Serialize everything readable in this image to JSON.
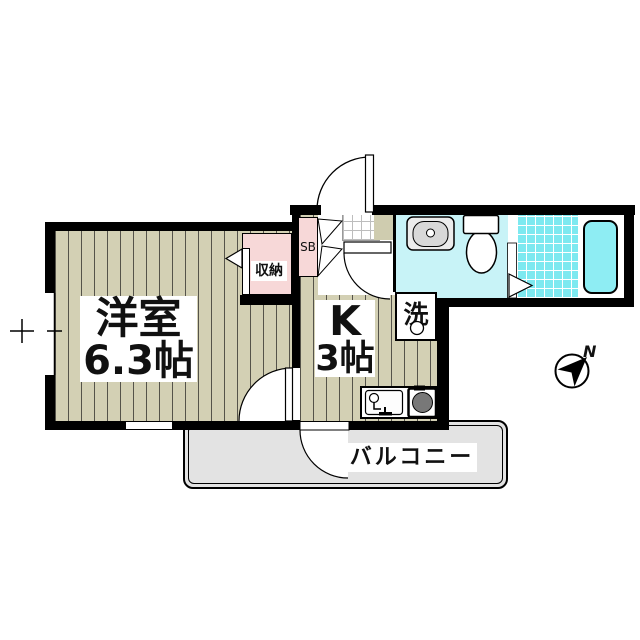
{
  "plan": {
    "western_room": {
      "name": "洋室",
      "area": "6.3帖"
    },
    "kitchen": {
      "name": "K",
      "area": "3帖"
    },
    "closet_label": "収納",
    "shoe_box_label": "SB",
    "laundry_label": "洗",
    "balcony_label": "バルコニー",
    "compass_north": "N"
  },
  "colors": {
    "wall": "#000000",
    "flooring_beige": "#d3d0b4",
    "closet_pink": "#f7d8d8",
    "washroom_cyan": "#c8f3f7",
    "bath_tile_cyan": "#7de9f0",
    "bathtub_cyan": "#8eedf3",
    "balcony_gray": "#e3e3e3",
    "stove_burner_gray": "#787878"
  }
}
